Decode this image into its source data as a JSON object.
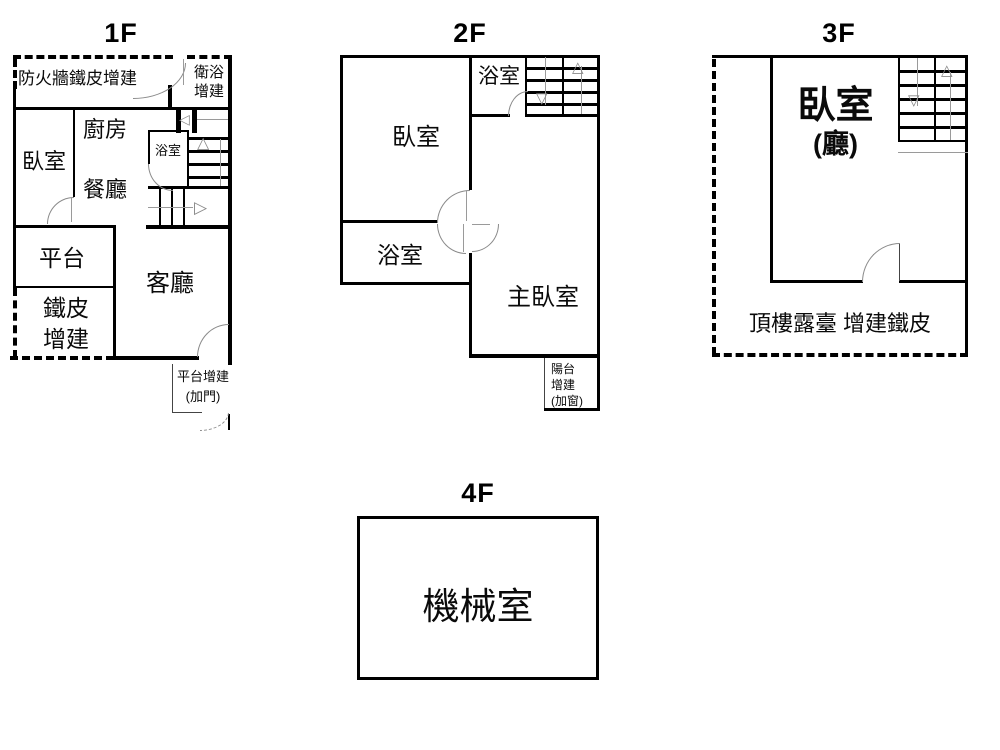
{
  "colors": {
    "wall": "#000000",
    "door_arc": "#8a8a8a",
    "stair_guide": "#9a9a9a",
    "background": "#ffffff"
  },
  "icons": {
    "stair_up_arrow": "△",
    "stair_down_arrow": "▽",
    "stair_right_arrow": "▷",
    "stair_left_arrow": "◁"
  },
  "floors": {
    "f1": {
      "title": "1F",
      "labels": {
        "fireproof_addition": "防火牆鐵皮增建",
        "bath_addition_line1": "衛浴",
        "bath_addition_line2": "增建",
        "bedroom": "臥室",
        "kitchen": "廚房",
        "dining": "餐廳",
        "bathroom": "浴室",
        "platform": "平台",
        "iron_addition_line1": "鐵皮",
        "iron_addition_line2": "增建",
        "living_room": "客廳",
        "platform_addition_line1": "平台增建",
        "platform_addition_line2": "(加門)"
      }
    },
    "f2": {
      "title": "2F",
      "labels": {
        "bedroom": "臥室",
        "bathroom_upper": "浴室",
        "bathroom_lower": "浴室",
        "master_bedroom": "主臥室",
        "balcony_addition_line1": "陽台",
        "balcony_addition_line2": "增建",
        "balcony_addition_line3": "(加窗)"
      }
    },
    "f3": {
      "title": "3F",
      "labels": {
        "bedroom": "臥室",
        "bedroom_hall": "(廳)",
        "roof_terrace": "頂樓露臺 增建鐵皮"
      }
    },
    "f4": {
      "title": "4F",
      "labels": {
        "machine_room": "機械室"
      }
    }
  }
}
